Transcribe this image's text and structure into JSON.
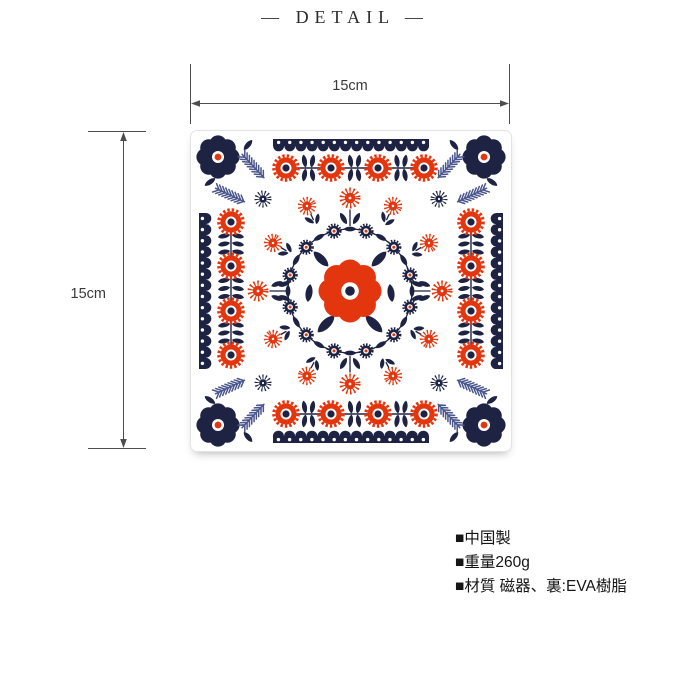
{
  "header": {
    "title": "— DETAIL —"
  },
  "dimension_labels": {
    "width": "15cm",
    "height": "15cm"
  },
  "specs": [
    "■中国製",
    "■重量260g",
    "■材質 磁器、裏:EVA樹脂"
  ],
  "colors": {
    "red": "#e3360f",
    "navy": "#1e2344",
    "fern": "#4a568c",
    "dim_line": "#4d4d4d",
    "text": "#151515"
  }
}
